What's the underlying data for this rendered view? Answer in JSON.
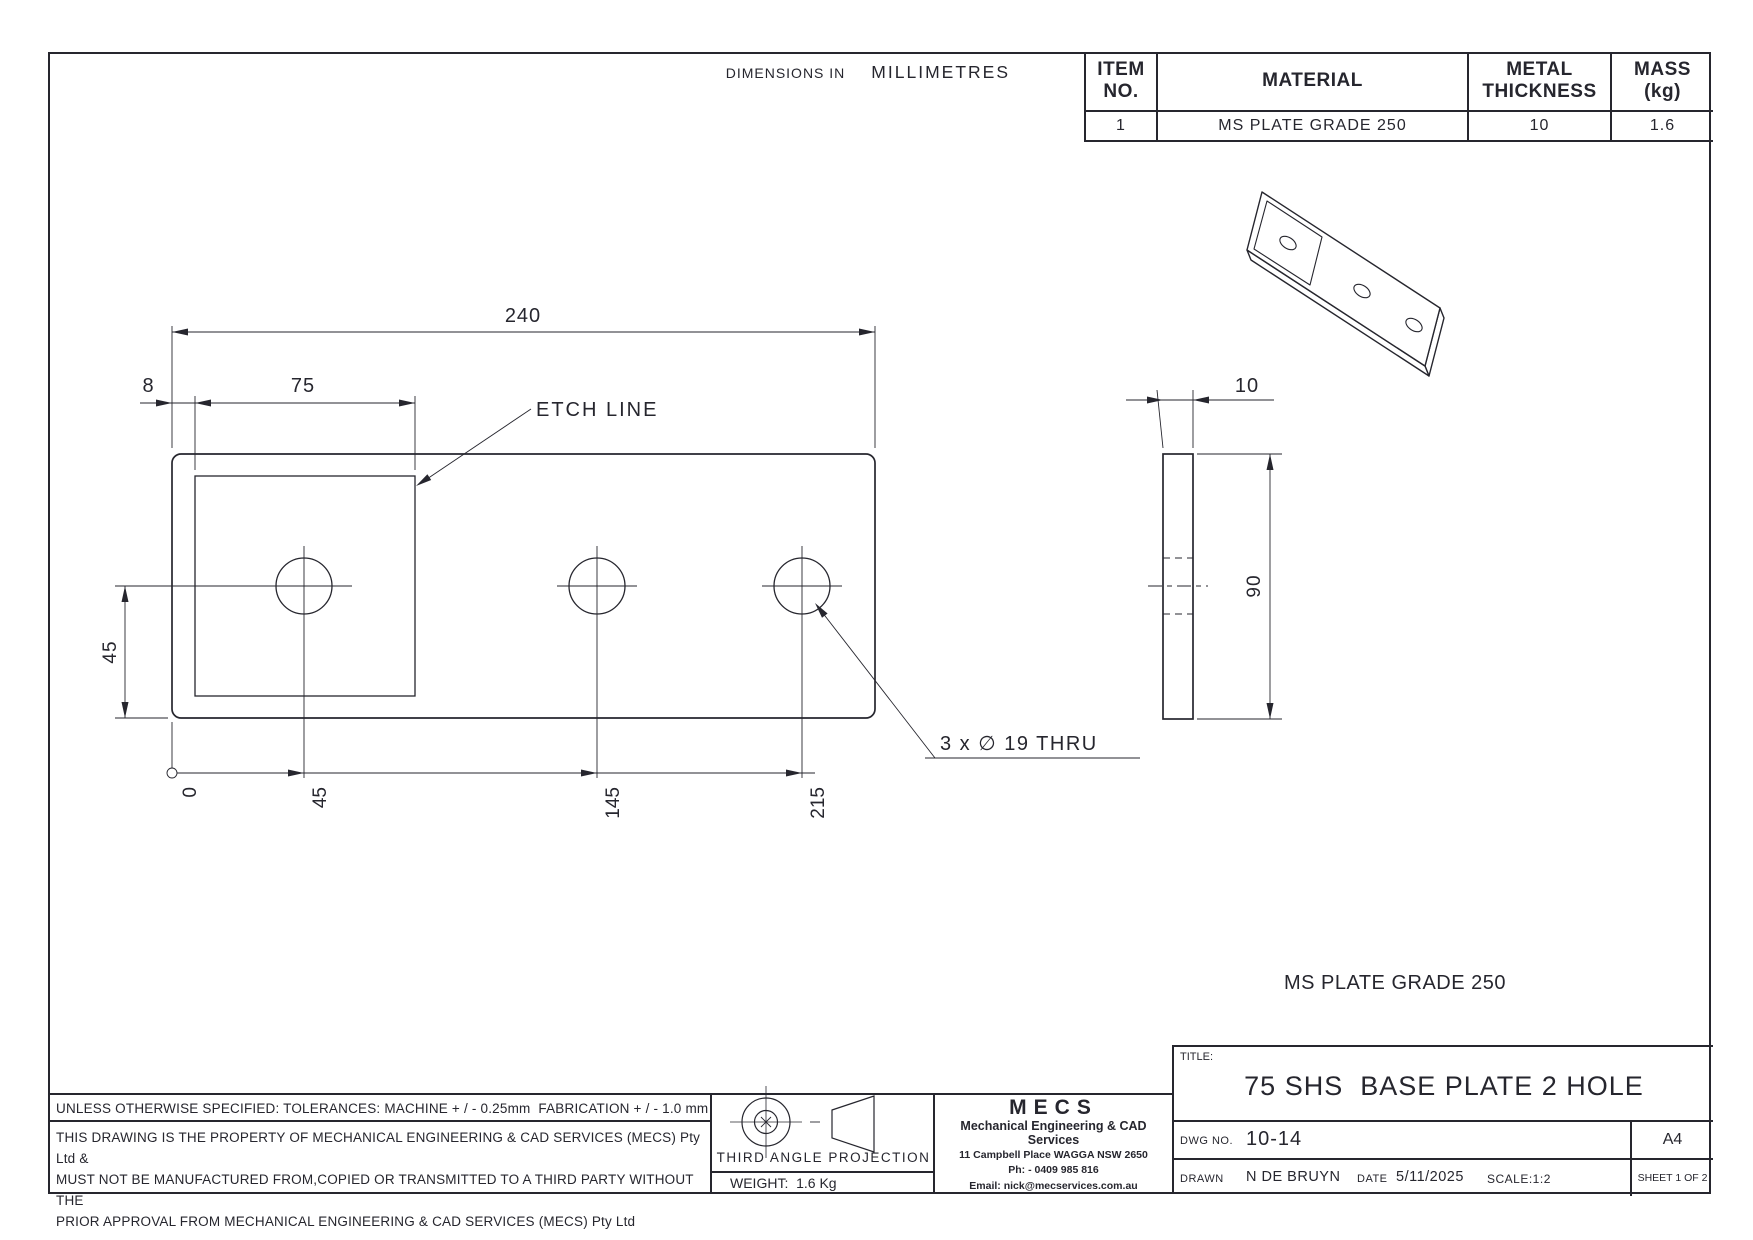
{
  "notes_top": {
    "dimensions_in": "DIMENSIONS IN",
    "units": "MILLIMETRES"
  },
  "parts_table": {
    "col_item": "ITEM NO.",
    "col_material": "MATERIAL",
    "col_thickness_1": "METAL",
    "col_thickness_2": "THICKNESS",
    "col_mass_1": "MASS",
    "col_mass_2": "(kg)",
    "row": {
      "item": "1",
      "material": "MS PLATE GRADE 250",
      "thickness": "10",
      "mass": "1.6"
    }
  },
  "front_view": {
    "dim_width": "240",
    "dim_offset": "8",
    "dim_etch_width": "75",
    "dim_hole_height": "45",
    "ordinates": [
      "0",
      "45",
      "145",
      "215"
    ],
    "etch_label": "ETCH LINE",
    "hole_note": "3 x ∅ 19 THRU"
  },
  "side_view": {
    "dim_thickness": "10",
    "dim_height": "90"
  },
  "material_note": "MS PLATE GRADE 250",
  "tolerance_note": "UNLESS OTHERWISE SPECIFIED: TOLERANCES: MACHINE + / - 0.25mm  FABRICATION + / - 1.0 mm",
  "property_note": [
    "THIS DRAWING IS THE PROPERTY OF MECHANICAL ENGINEERING & CAD SERVICES (MECS) Pty Ltd &",
    "MUST NOT BE MANUFACTURED FROM,COPIED OR TRANSMITTED TO A THIRD PARTY WITHOUT THE",
    "PRIOR APPROVAL FROM MECHANICAL ENGINEERING & CAD SERVICES (MECS) Pty Ltd"
  ],
  "projection": {
    "label": "THIRD ANGLE PROJECTION",
    "weight": "WEIGHT:  1.6 Kg"
  },
  "company": {
    "logo": "MECS",
    "name": "Mechanical Engineering & CAD Services",
    "address": "11 Campbell Place WAGGA NSW 2650",
    "phone": "Ph: - 0409 985 816",
    "email": "Email: nick@mecservices.com.au"
  },
  "title_block": {
    "title_label": "TITLE:",
    "title": "75 SHS  BASE PLATE 2 HOLE",
    "dwg_label": "DWG NO.",
    "dwg_no": "10-14",
    "paper_size": "A4",
    "drawn_label": "DRAWN",
    "drawn_by": "N DE BRUYN",
    "date_label": "DATE",
    "date_value": "5/11/2025",
    "scale": "SCALE:1:2",
    "sheet": "SHEET 1 OF 2"
  }
}
